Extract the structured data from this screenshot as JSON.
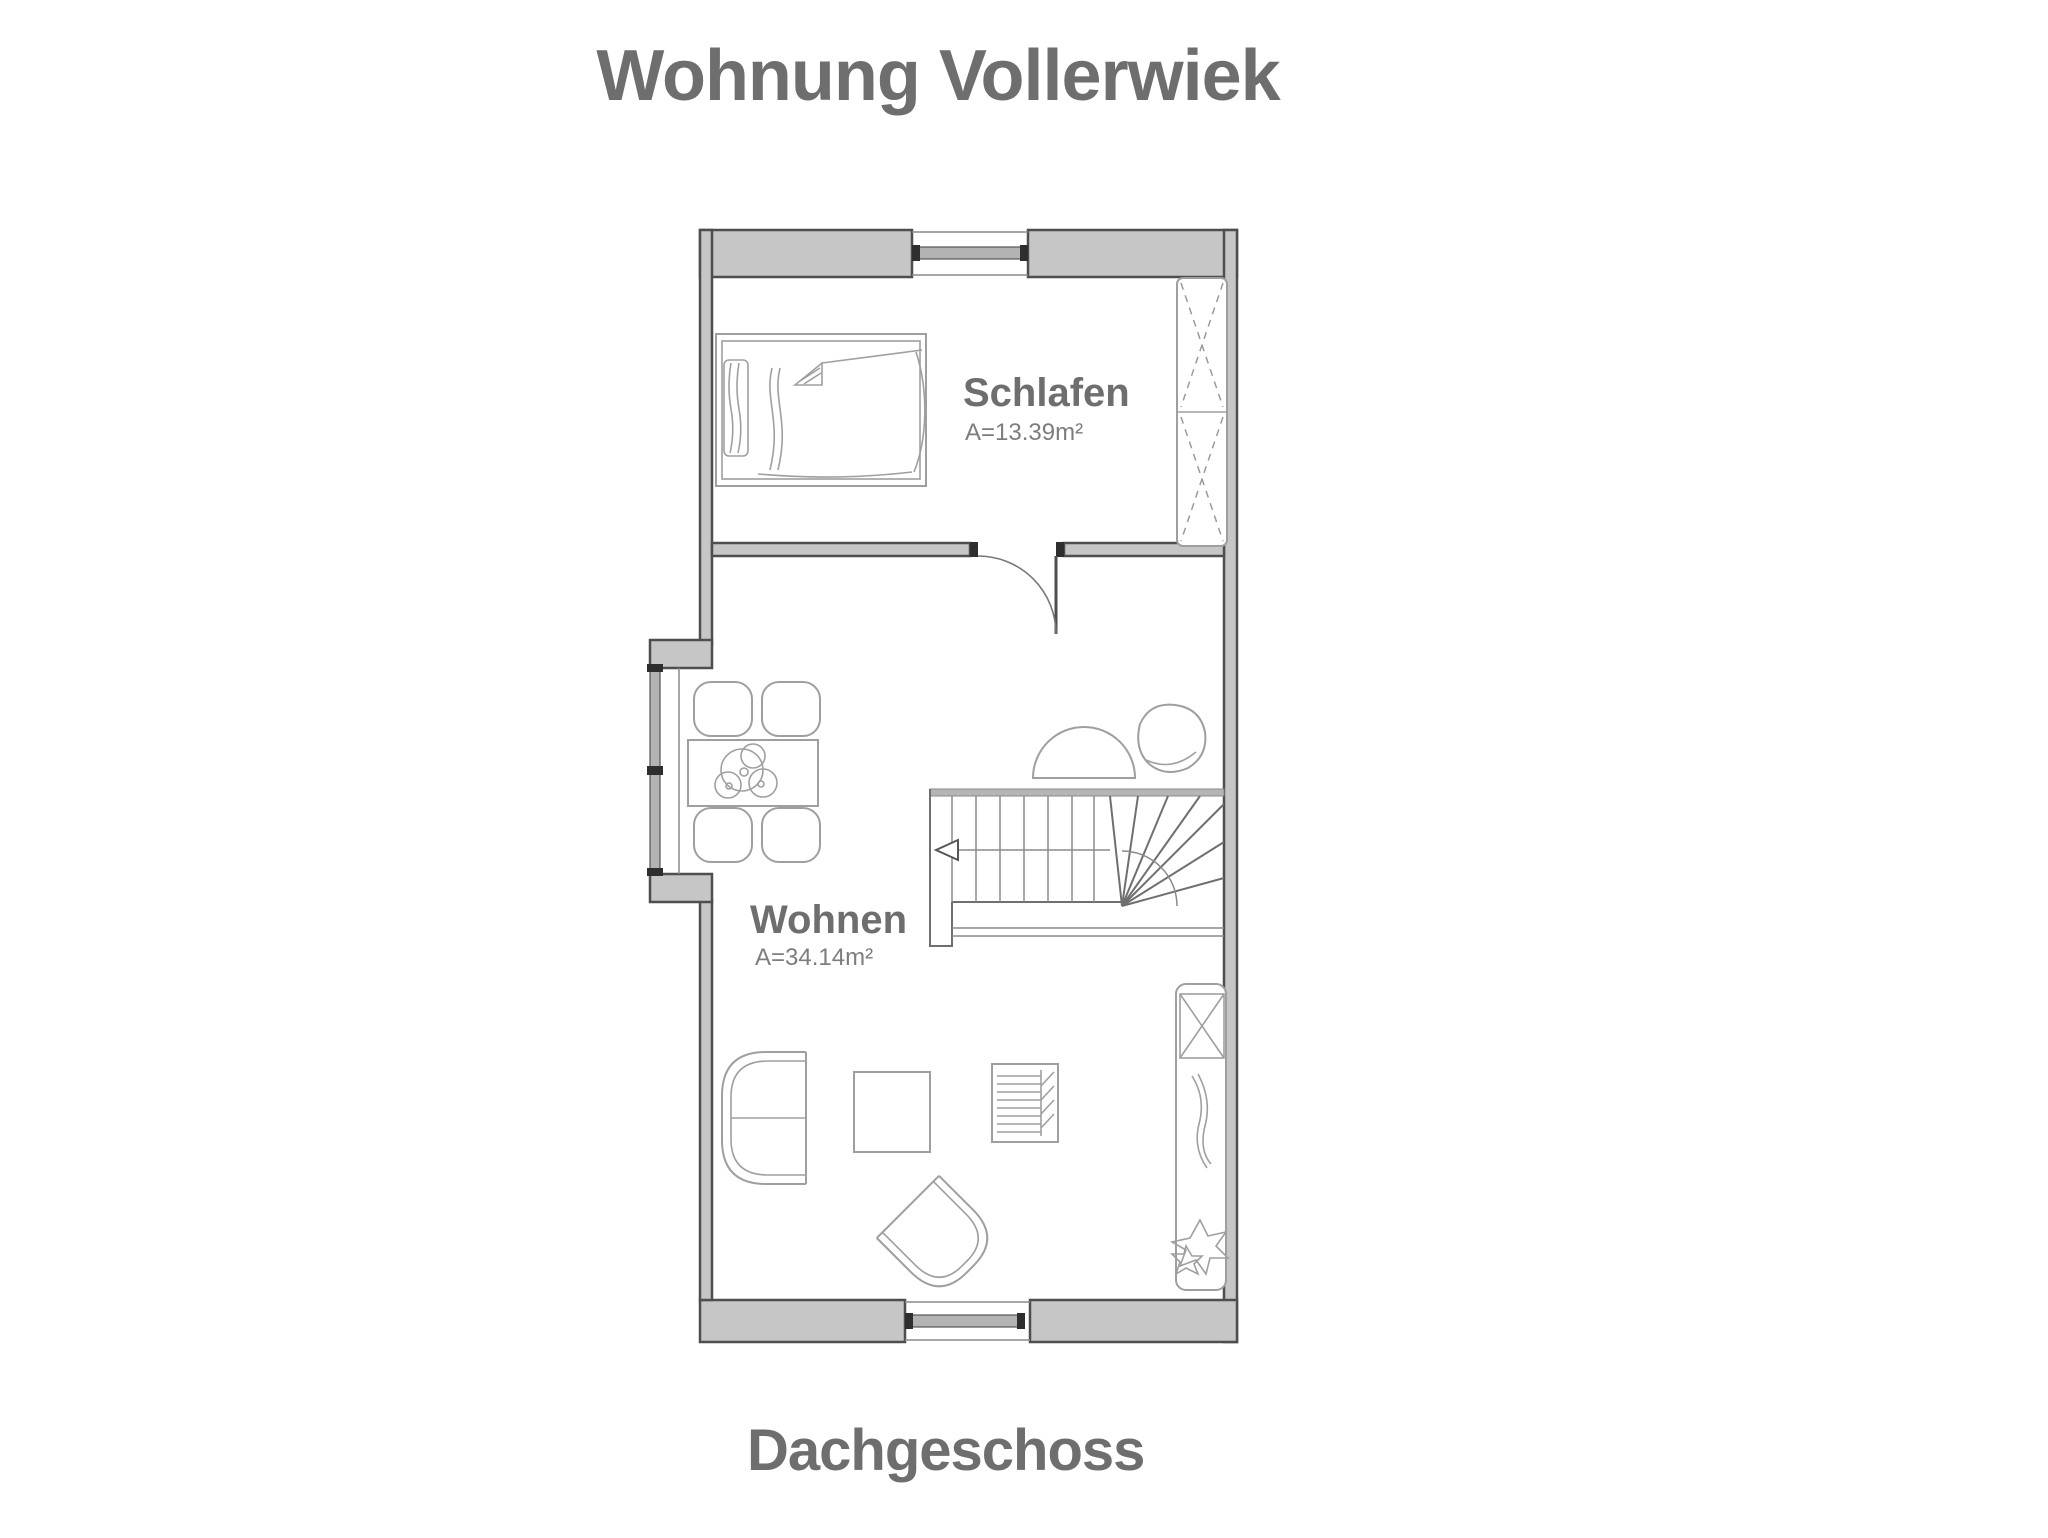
{
  "title": "Wohnung Vollerwiek",
  "floor_label": "Dachgeschoss",
  "rooms": {
    "schlafen": {
      "name": "Schlafen",
      "area": "A=13.39m²"
    },
    "wohnen": {
      "name": "Wohnen",
      "area": "A=34.14m²"
    }
  },
  "symbols": {
    "bedroom": [
      "bed",
      "wardrobe",
      "window"
    ],
    "living_room": [
      "dining-table",
      "dining-chairs",
      "table-plant",
      "staircase",
      "stair-direction-arrow",
      "half-round-table",
      "pouf",
      "sofa",
      "coffee-table",
      "shelf-unit",
      "armchair",
      "sideboard",
      "leaf-decoration",
      "plant",
      "interior-door",
      "niche-window",
      "window"
    ]
  },
  "colors": {
    "background": "#ffffff",
    "wall_fill": "#c6c6c6",
    "wall_outline": "#4e4e4e",
    "interior_line": "#8f8f8f",
    "furniture_line": "#9f9f9f",
    "stair_line": "#6f6f6f",
    "glass_fill": "#b3b3b3",
    "frame_dark": "#2e2e2e",
    "text_color": "#6e6e6e"
  }
}
